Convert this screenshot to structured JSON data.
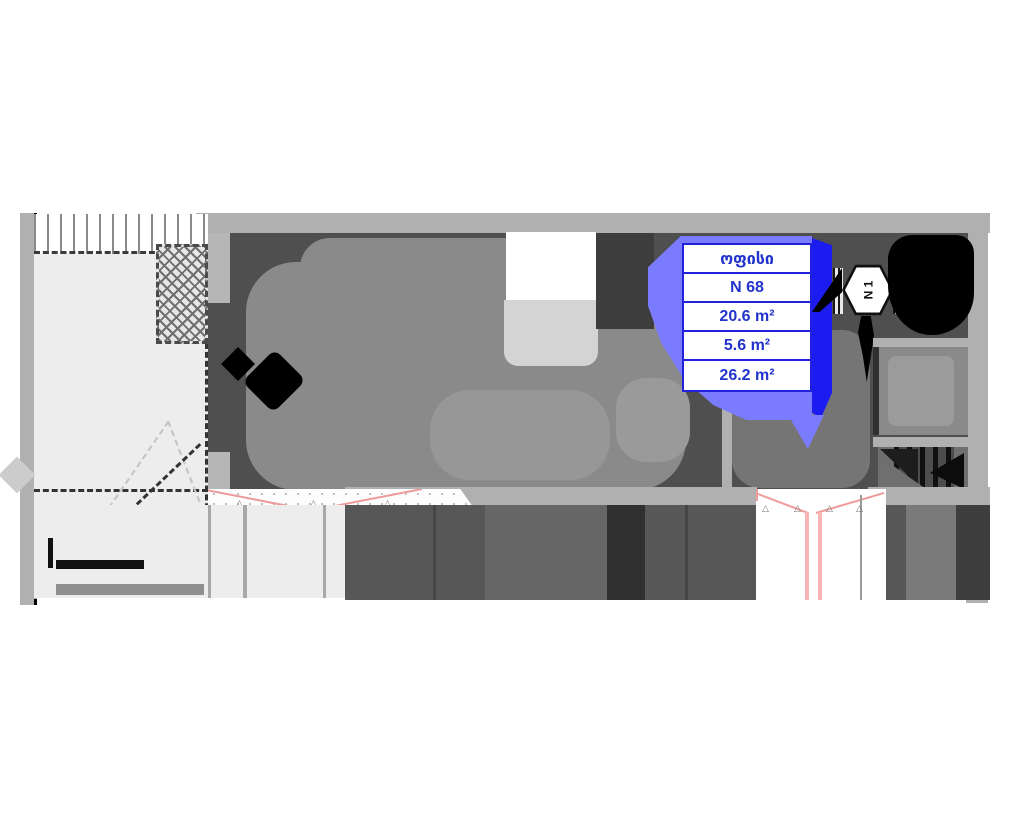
{
  "plan_title": "apartment-floor-plan",
  "unit_card": {
    "room_type": "ოფისი",
    "unit_number": "N 68",
    "areas": [
      "20.6 m²",
      "5.6 m²",
      "26.2 m²"
    ]
  },
  "stair_badge": {
    "label": "N 1"
  },
  "colors": {
    "highlight_border": "#2222dd",
    "highlight_fill": "#7b7bff",
    "highlight_strong": "#1c1cf0",
    "label_text": "#2133cc",
    "accent_red": "#ef9a9a",
    "wall": "#b0b0b0",
    "room_dark": "#4f4f4f",
    "room_mid": "#8a8a8a",
    "terrace": "#ededed",
    "solid_black": "#000000"
  }
}
